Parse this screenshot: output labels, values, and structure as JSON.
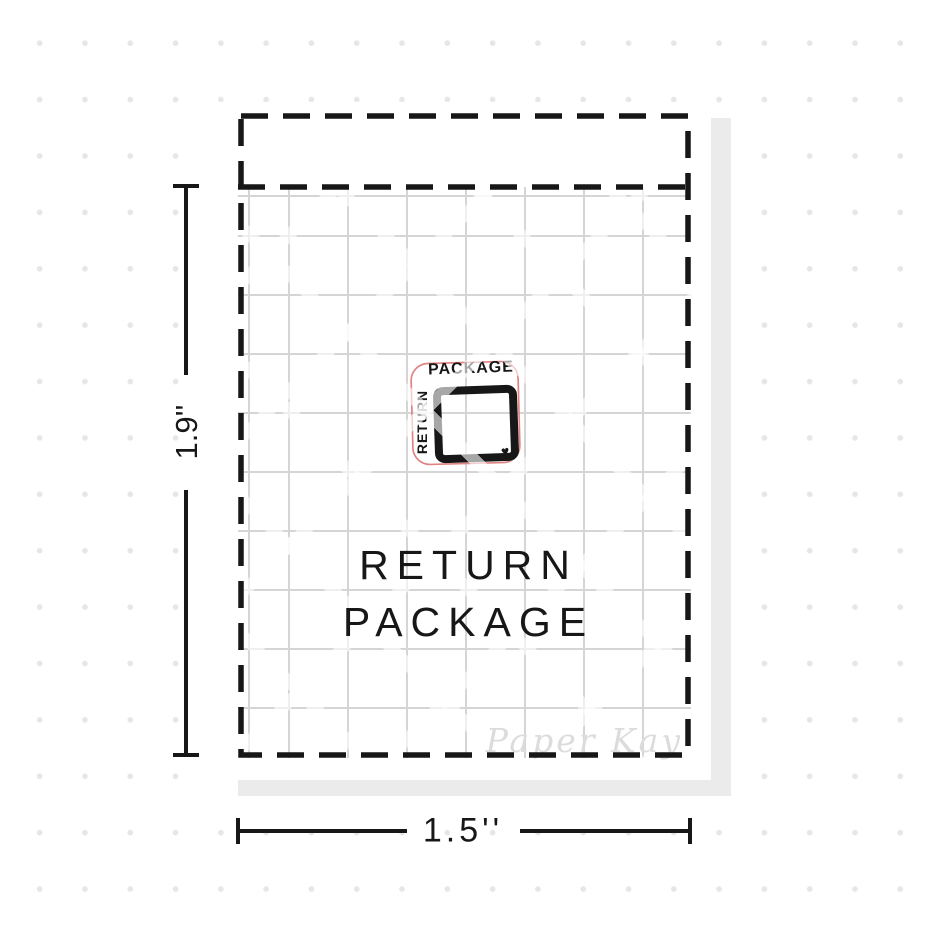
{
  "sheet": {
    "title_line1": "RETURN",
    "title_line2": "PACKAGE",
    "brand_watermark": "Paper Kay"
  },
  "sticker_icon": {
    "top_text": "PACKAGE",
    "left_text": "RETURN",
    "heart_glyph": "♥"
  },
  "measurements": {
    "height_label": "1.9''",
    "width_label": "1.5''"
  },
  "colors": {
    "ink": "#171717",
    "grid_line": "#d5d5d5",
    "background_dot": "#e6e6e6",
    "sheet_shadow": "#ebebeb",
    "sticker_cut_outline": "#e08383",
    "watermark_text": "#dcdcdc"
  }
}
